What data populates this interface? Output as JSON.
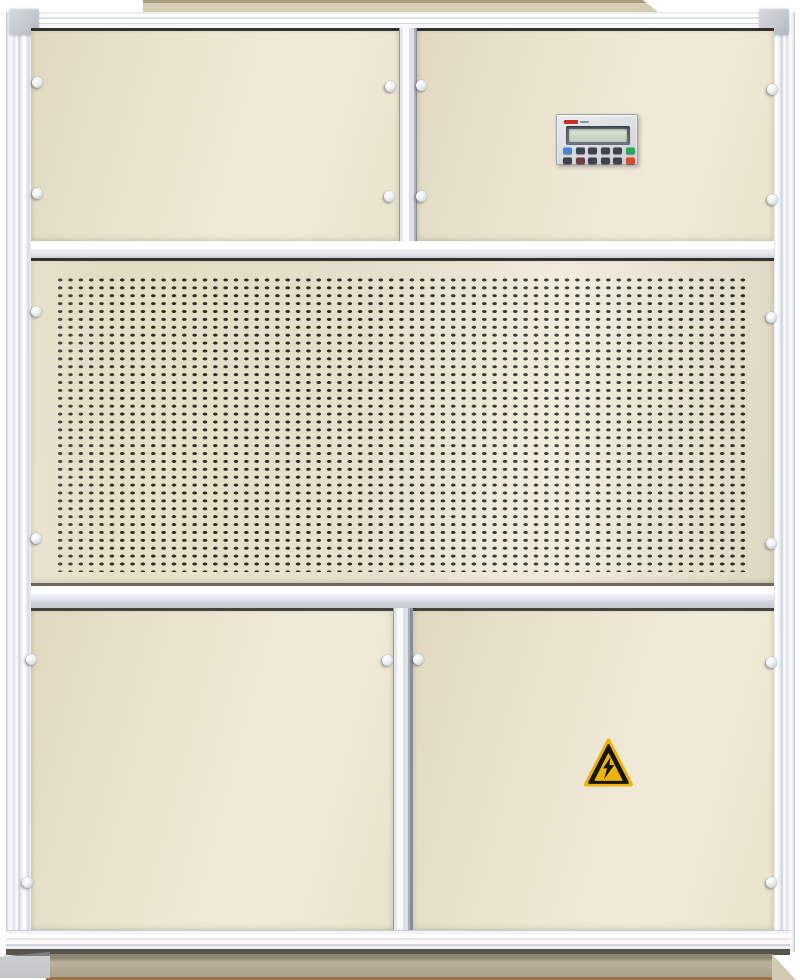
{
  "scene": {
    "type": "equipment-photo",
    "subject": "Industrial air-handling / dehumidifier cabinet, front view, cut out on white background",
    "background": "#ffffff"
  },
  "colors": {
    "panel_beige": "#e9e3cd",
    "panel_beige_deep": "#e0d9bf",
    "panel_highlight": "#f0ead9",
    "gap_dark": "#34322c",
    "slot_dark": "#2e2c25",
    "top_cap": "#d6cdb2",
    "top_cap_edge": "#a89d80",
    "base_tan": "#b9b19a",
    "base_shadow": "#8c8673",
    "base_edge_brown": "#9a7448",
    "corner_cap": "#c5c9d0",
    "hazard_yellow": "#ecb50d",
    "hazard_black": "#17150f",
    "lcd_green": "#ccd8c6",
    "brand_red": "#c23327"
  },
  "grille": {
    "pitch_x_px": 10.35,
    "pitch_y_px": 7.9,
    "slot_rx_px": 3.4,
    "slot_ry_px": 2.1,
    "approx_columns": 67,
    "approx_rows": 37
  },
  "control_panel": {
    "description": "LCD controller with membrane keypad, blank pale-green display, small red brand mark (illegible)",
    "button_rows": [
      [
        "#4a82d8",
        "#3c4350",
        "#3c4350",
        "#3c4350",
        "#3c4350",
        "#2ba45c"
      ],
      [
        "#3c4350",
        "#6e3c44",
        "#3c4350",
        "#3c4350",
        "#3c4350",
        "#d94a2b"
      ]
    ]
  },
  "warning_label": {
    "meaning": "electrical-hazard",
    "shape": "triangle",
    "symbol": "lightning-bolt"
  },
  "fasteners": {
    "count": 18,
    "style": "round white push fastener"
  }
}
